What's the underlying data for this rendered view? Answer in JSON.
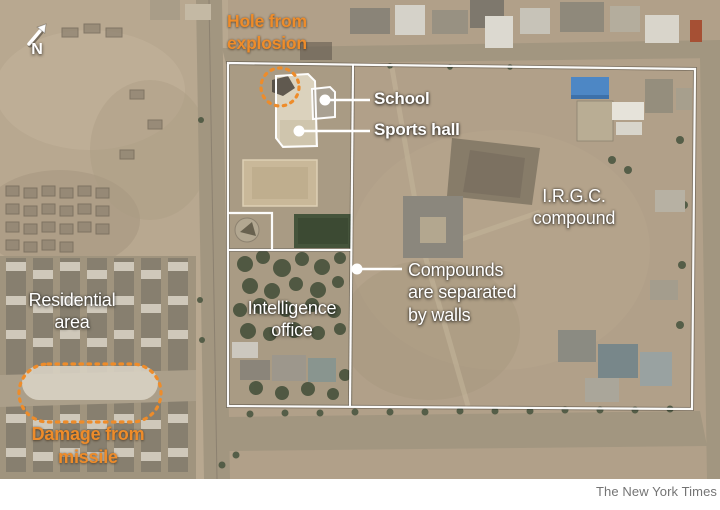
{
  "figure": {
    "credit": "The New York Times",
    "compass_label": "N"
  },
  "colors": {
    "annotation_orange": "#ee8c2a",
    "annotation_white": "#ffffff",
    "credit_gray": "#747474",
    "satellite_ground_tan": "#b3a28b",
    "blue_roof": "#4d87c5"
  },
  "labels": {
    "hole_from_explosion": {
      "lines": [
        "Hole from",
        "explosion"
      ]
    },
    "school": {
      "text": "School"
    },
    "sports_hall": {
      "text": "Sports hall"
    },
    "irgc_compound": {
      "lines": [
        "I.R.G.C.",
        "compound"
      ]
    },
    "compounds_separated": {
      "lines": [
        "Compounds",
        "are separated",
        "by walls"
      ]
    },
    "residential_area": {
      "lines": [
        "Residential",
        "area"
      ]
    },
    "intelligence_office": {
      "lines": [
        "Intelligence",
        "office"
      ]
    },
    "damage_from_missile": {
      "lines": [
        "Damage from",
        "missile"
      ]
    }
  }
}
